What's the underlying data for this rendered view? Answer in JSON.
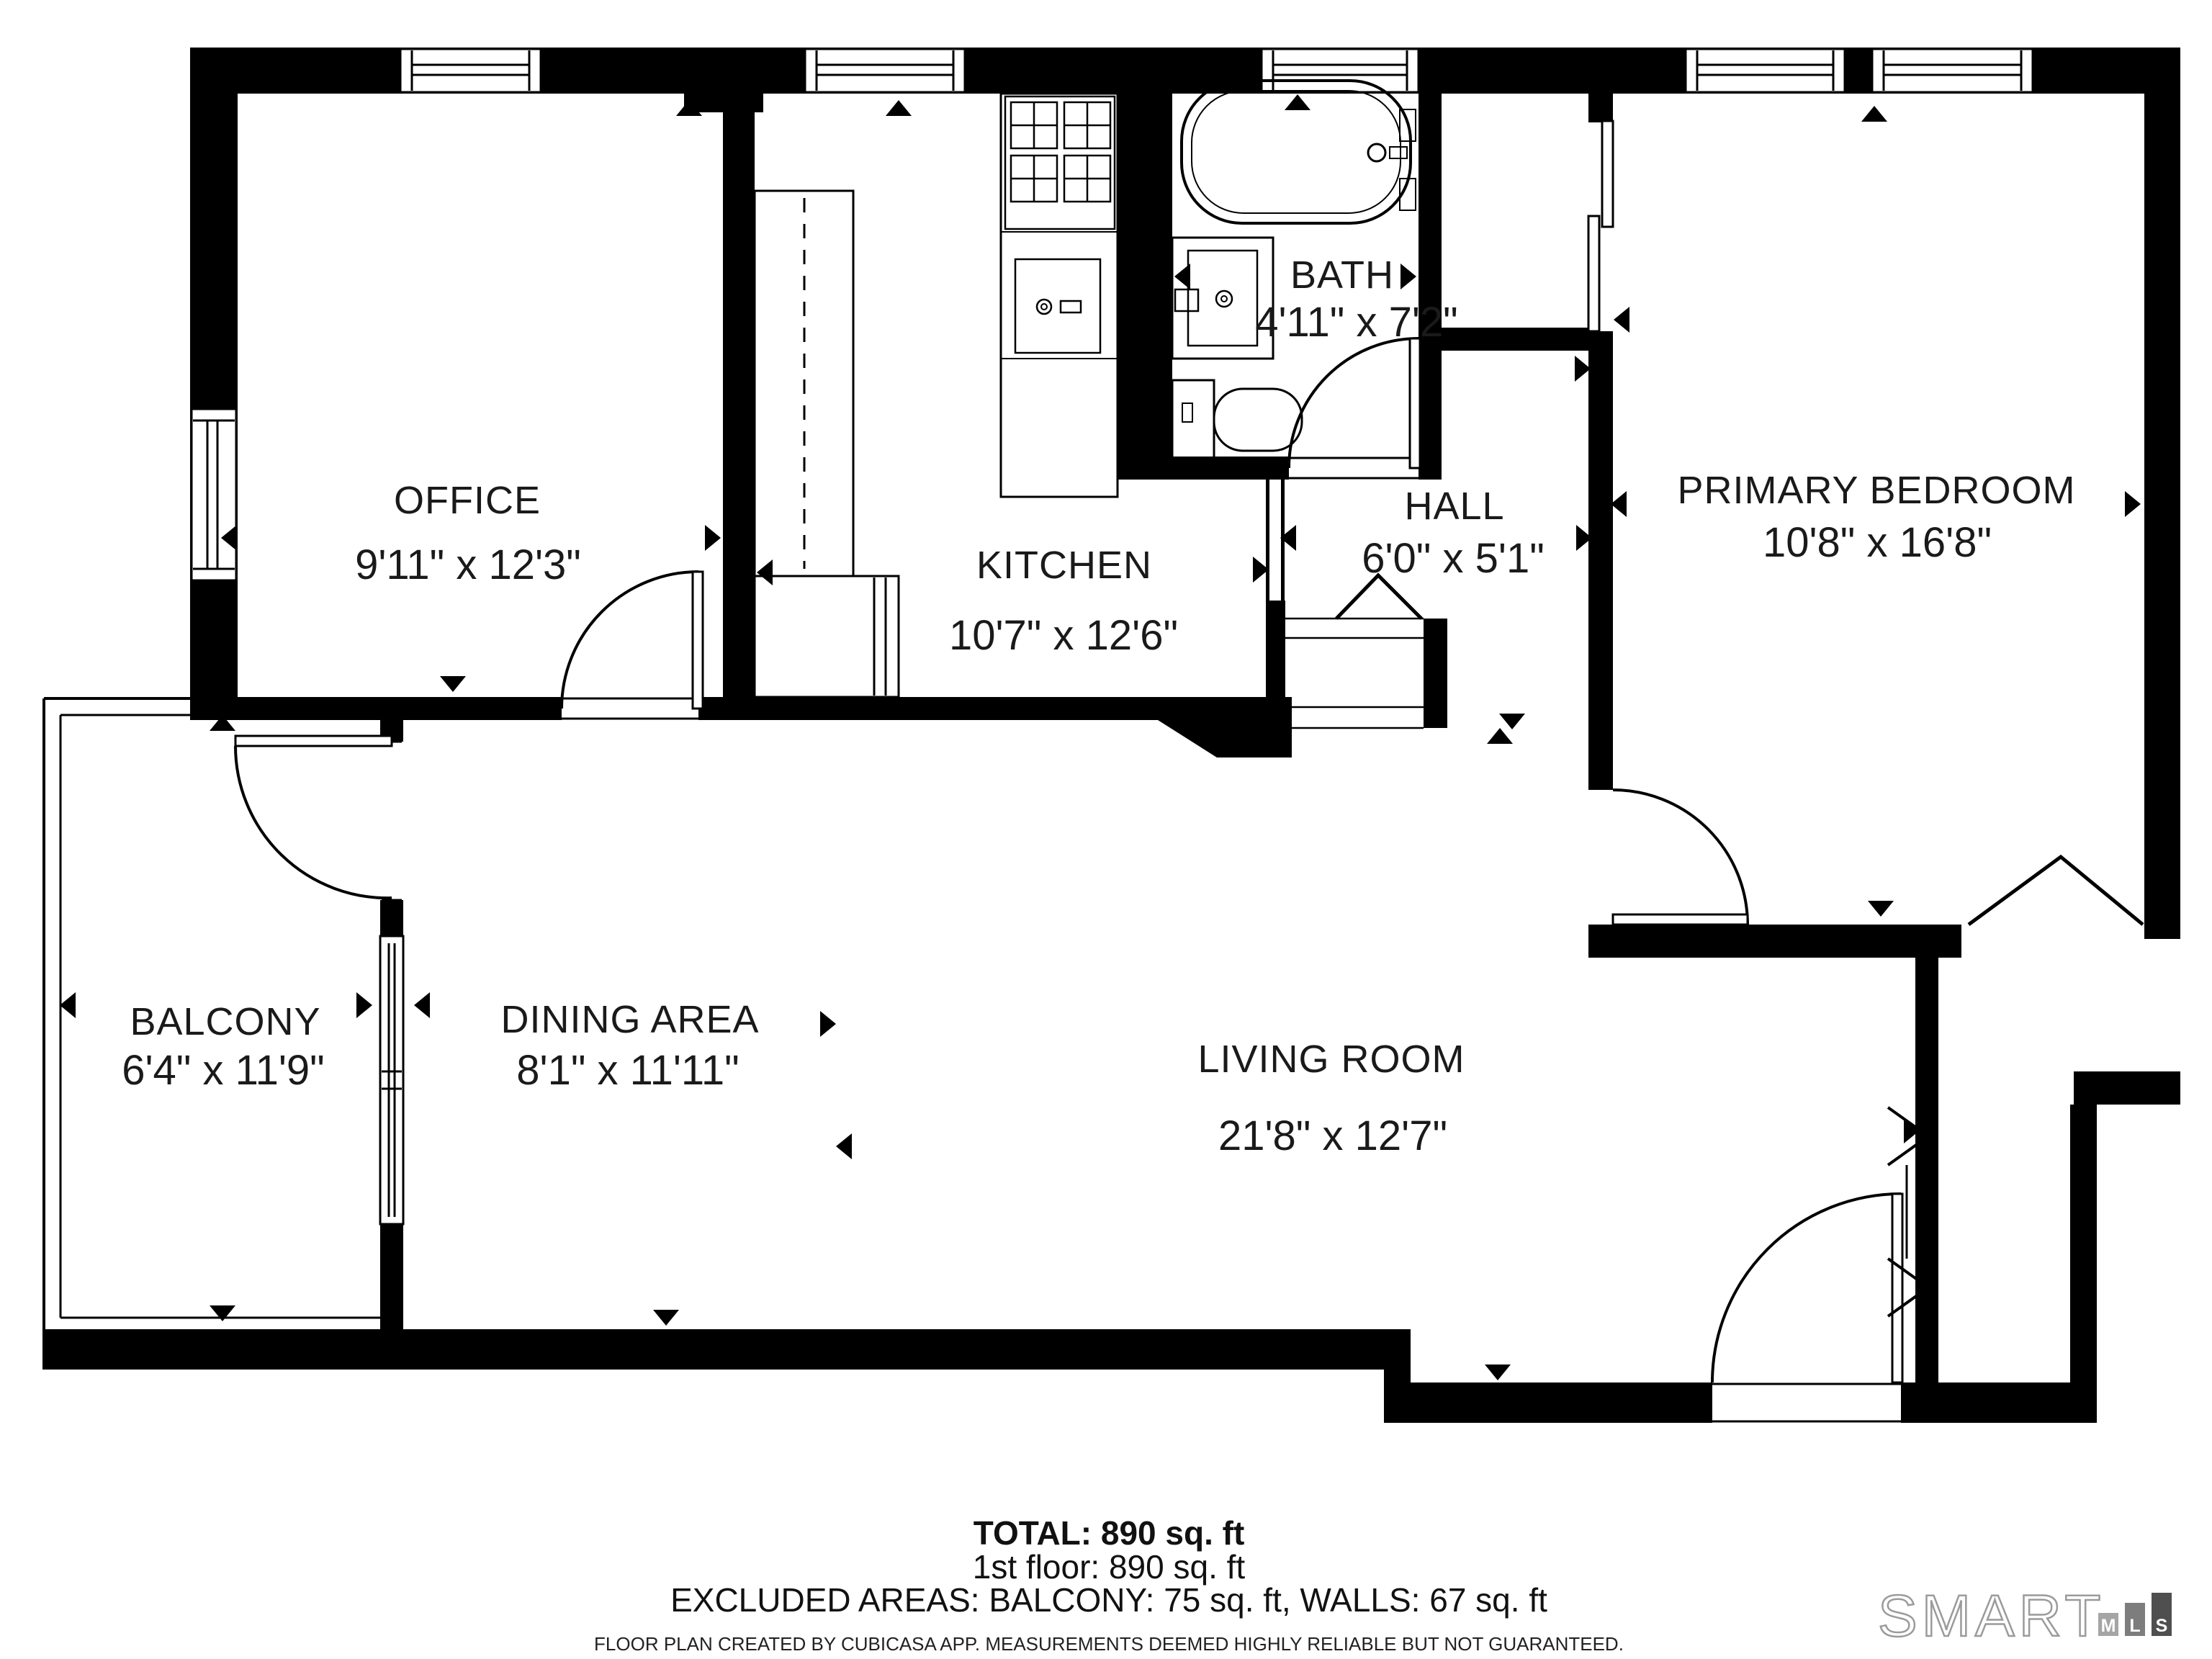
{
  "rooms": {
    "office": {
      "name": "OFFICE",
      "dims": "9'11\" x 12'3\""
    },
    "kitchen": {
      "name": "KITCHEN",
      "dims": "10'7\" x 12'6\""
    },
    "bath": {
      "name": "BATH",
      "dims": "4'11\" x 7'2\""
    },
    "hall": {
      "name": "HALL",
      "dims": "6'0\" x 5'1\""
    },
    "bedroom": {
      "name": "PRIMARY BEDROOM",
      "dims": "10'8\" x 16'8\""
    },
    "balcony": {
      "name": "BALCONY",
      "dims": "6'4\" x 11'9\""
    },
    "dining": {
      "name": "DINING AREA",
      "dims": "8'1\" x 11'11\""
    },
    "living": {
      "name": "LIVING ROOM",
      "dims": "21'8\" x 12'7\""
    }
  },
  "summary": {
    "total": "TOTAL: 890 sq. ft",
    "floor": "1st floor: 890 sq. ft",
    "excluded": "EXCLUDED AREAS: BALCONY: 75 sq. ft, WALLS: 67 sq. ft"
  },
  "disclaimer": "FLOOR PLAN CREATED BY CUBICASA APP. MEASUREMENTS DEEMED HIGHLY RELIABLE BUT NOT GUARANTEED.",
  "logo": {
    "brand": "SMART",
    "bars": [
      "M",
      "L",
      "S"
    ]
  },
  "colors": {
    "wall": "#000000",
    "background": "#ffffff",
    "logo_outline": "#9b9b9b",
    "bar_m": "#a5a5a5",
    "bar_l": "#7d7d7d",
    "bar_s": "#4f4f4f"
  }
}
